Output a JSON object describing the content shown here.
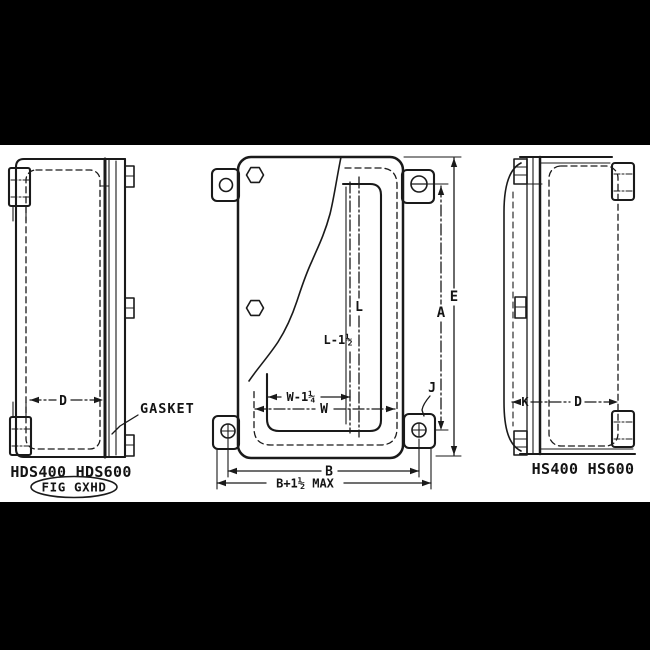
{
  "colors": {
    "page_background": "#000000",
    "paper": "#ffffff",
    "ink": "#1a1a1a"
  },
  "drawing": {
    "left_view": {
      "model_label": "HDS400 HDS600",
      "figure_label": "FIG GXHD",
      "gasket_label": "GASKET",
      "dim_d": "D"
    },
    "center_view": {
      "dim_e": "E",
      "dim_a": "A",
      "dim_j": "J",
      "dim_l": "L",
      "dim_l_minus": "L-1½",
      "dim_w_minus": "W-1¼",
      "dim_w": "W",
      "dim_b": "B",
      "dim_b_max": "B+1½ MAX"
    },
    "right_view": {
      "model_label": "HS400 HS600",
      "dim_k": "K",
      "dim_d": "D"
    }
  }
}
